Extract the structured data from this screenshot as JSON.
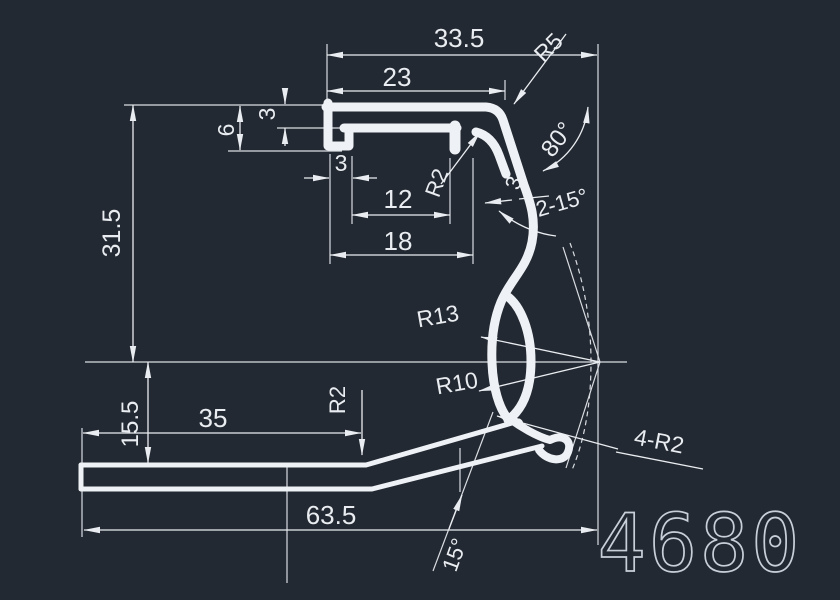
{
  "drawing": {
    "part_number": "4680",
    "dims": {
      "width_overall": "33.5",
      "width_inner": "23",
      "radius_top_corner": "R5",
      "cap_thickness": "3",
      "lip_height": "6",
      "lip_foot_width": "3",
      "height_upper": "31.5",
      "slot_offset": "12",
      "slot_width": "18",
      "radius_slot": "R2",
      "angle_wall": "80°",
      "wall_thickness": "3",
      "angle_draft": "2-15°",
      "radius_outer_curve": "R13",
      "radius_inner_curve": "R10",
      "height_lower": "15.5",
      "base_length": "35",
      "radius_bend": "R2",
      "radius_foot": "4-R2",
      "base_overall": "63.5",
      "angle_base": "15°"
    },
    "colors": {
      "background": "#232932",
      "lines": "#eef1f5",
      "thin_lines": "#d9dde2",
      "part_number_color": "#c9cfd8"
    }
  }
}
